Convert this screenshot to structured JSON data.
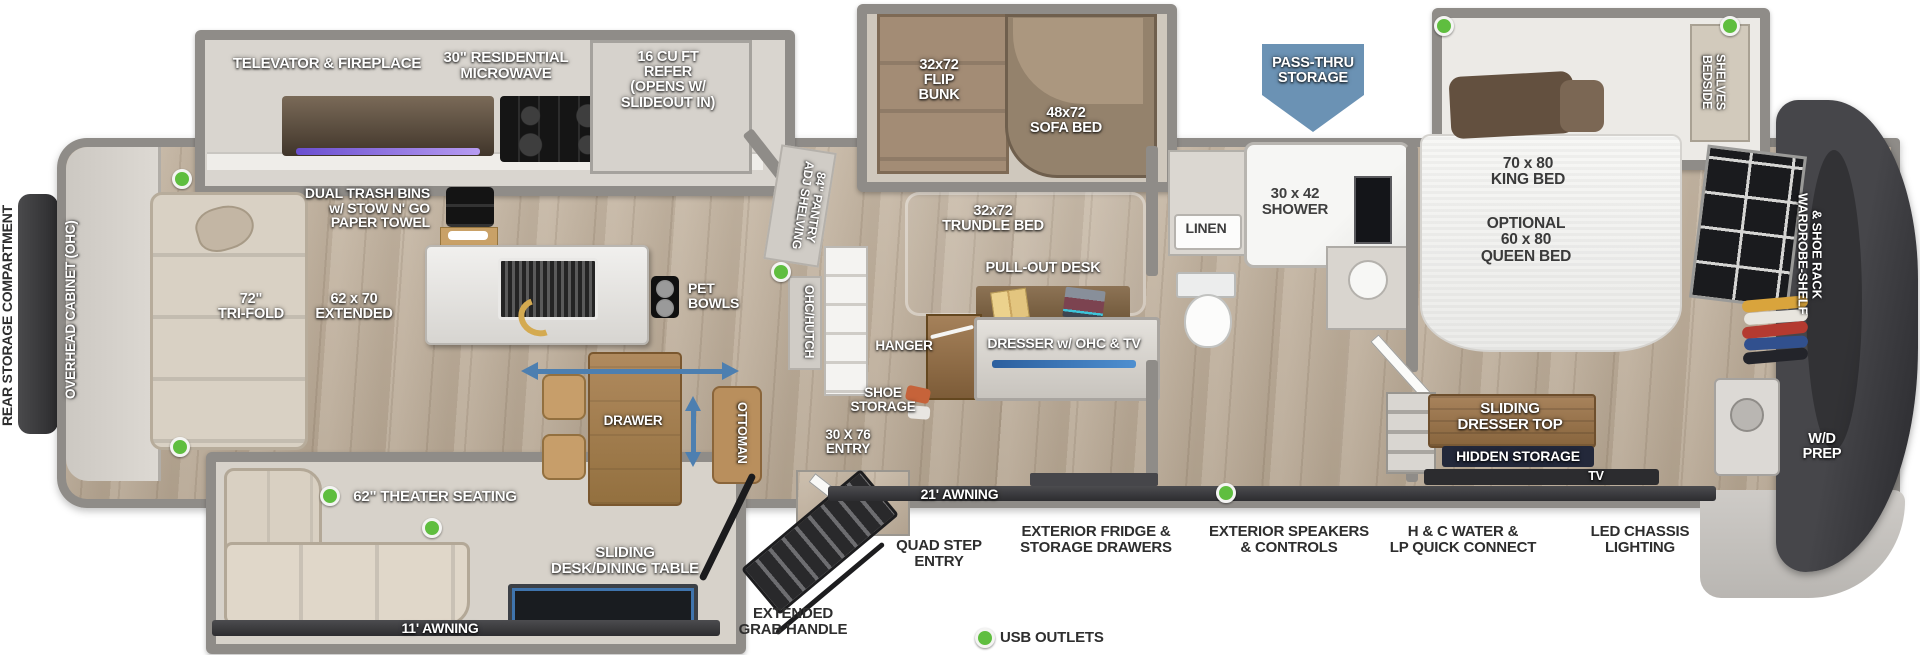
{
  "colors": {
    "accent_blue": "#4d7fb0",
    "pass_thru_blue": "#6b92b4",
    "usb_green": "#5fbe3f",
    "wall_gray": "#8f8c88",
    "awning_dark": "#35353a",
    "wood_brown": "#a8835c"
  },
  "exterior": {
    "rear_storage": "REAR STORAGE COMPARTMENT",
    "pass_thru": "PASS-THRU\nSTORAGE",
    "awning_21": "21' AWNING",
    "awning_11": "11' AWNING",
    "grab_handle": "EXTENDED\nGRAB HANDLE",
    "quad_step": "QUAD STEP\nENTRY",
    "ext_fridge": "EXTERIOR FRIDGE &\nSTORAGE DRAWERS",
    "ext_speakers": "EXTERIOR SPEAKERS\n& CONTROLS",
    "hc_water": "H & C WATER &\nLP QUICK CONNECT",
    "led_lighting": "LED CHASSIS\nLIGHTING",
    "entry": "30 X 76\nENTRY"
  },
  "kitchen": {
    "televator": "TELEVATOR & FIREPLACE",
    "microwave": "30\" RESIDENTIAL\nMICROWAVE",
    "refer": "16 CU FT\nREFER\n(OPENS W/\nSLIDEOUT IN)",
    "trash": "DUAL TRASH BINS\nw/ STOW N' GO\nPAPER TOWEL",
    "pet_bowls": "PET\nBOWLS",
    "pantry": "84\" PANTRY\nADJ SHELVING",
    "hutch": "OHC/HUTCH"
  },
  "living": {
    "ohc": "OVERHEAD CABINET (OHC)",
    "tri_fold": "72\"\nTRI-FOLD",
    "extended": "62 x 70\nEXTENDED",
    "theater": "62\" THEATER SEATING",
    "sliding_desk": "SLIDING\nDESK/DINING TABLE",
    "drawer": "DRAWER",
    "ottoman": "OTTOMAN"
  },
  "bunk_room": {
    "flip_bunk": "32x72\nFLIP\nBUNK",
    "sofa_bed": "48x72\nSOFA BED",
    "trundle": "32x72\nTRUNDLE BED",
    "pullout_desk": "PULL-OUT DESK",
    "dresser": "DRESSER w/ OHC & TV",
    "hanger": "HANGER",
    "shoe_storage": "SHOE\nSTORAGE"
  },
  "bathroom": {
    "linen": "LINEN",
    "shower": "30 x 42\nSHOWER"
  },
  "bedroom": {
    "king": "70 x 80\nKING BED",
    "queen": "OPTIONAL\n60 x 80\nQUEEN BED",
    "bedside": "BEDSIDE\nSHELVES",
    "wardrobe": "WARDROBE-SHELF\n& SHOE RACK",
    "sliding_dresser": "SLIDING\nDRESSER TOP",
    "hidden_storage": "HIDDEN STORAGE",
    "tv": "TV",
    "wd_prep": "W/D\nPREP"
  },
  "legend": {
    "usb": "USB OUTLETS"
  }
}
